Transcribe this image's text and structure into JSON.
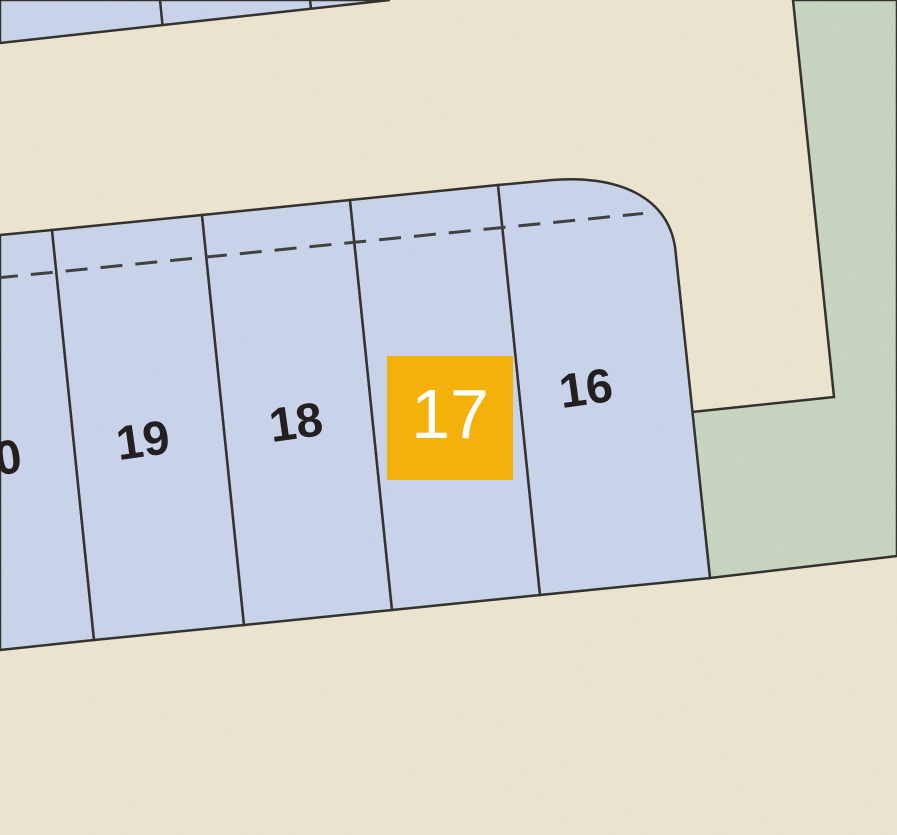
{
  "map": {
    "selected_lot": "17",
    "colors": {
      "road_fill": "#EDE6D0",
      "lot_fill": "#C9D4EC",
      "green_fill": "#C7D5C0",
      "line": "#2D2A26",
      "dashed_line": "#3A3A38",
      "highlight": "#F4B10A",
      "lot_number": "#231F20",
      "highlight_number": "#FFFFFF"
    },
    "lots": [
      {
        "number": "20",
        "highlighted": false
      },
      {
        "number": "19",
        "highlighted": false
      },
      {
        "number": "18",
        "highlighted": false
      },
      {
        "number": "17",
        "highlighted": true
      },
      {
        "number": "16",
        "highlighted": false
      }
    ]
  }
}
